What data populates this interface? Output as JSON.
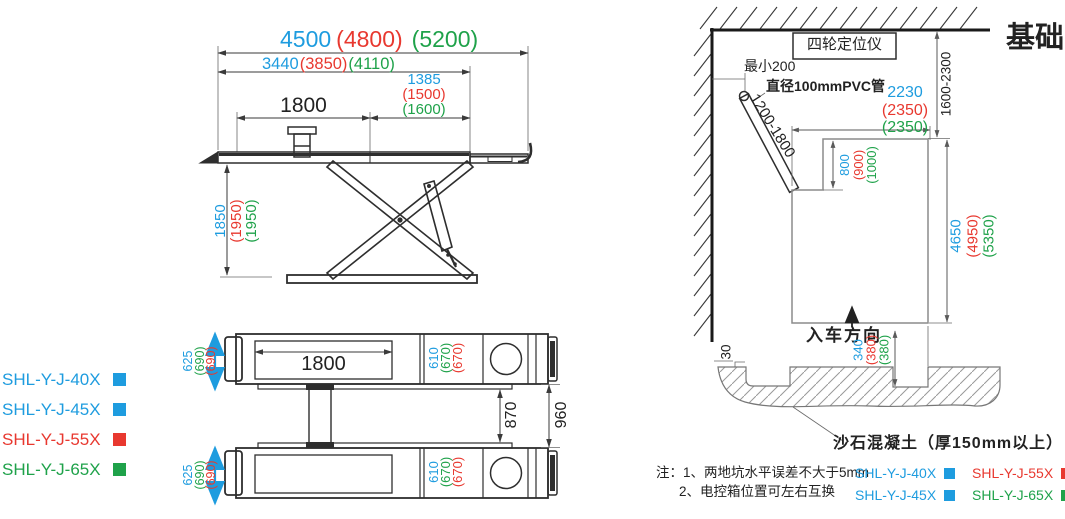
{
  "drawing": {
    "title": "基础图",
    "palette": {
      "blue": "#1E9CDF",
      "red": "#E8382F",
      "green": "#1FA24A"
    },
    "side_view": {
      "dim_total_length": {
        "v40": "4500",
        "v55": "(4800)",
        "v65": "(5200)"
      },
      "dim_inner_length": {
        "v40": "3440",
        "v55": "(3850)",
        "v65": "(4110)"
      },
      "dim_right_platform": {
        "v40": "1385",
        "v55": "(1500)",
        "v65": "(1600)"
      },
      "dim_tread_length": "1800",
      "dim_lift_height": {
        "v40": "1850",
        "v55": "(1950)",
        "v65": "(1950)"
      }
    },
    "top_view": {
      "dim_tread_length": "1800",
      "dim_platform_width": {
        "v40": "625",
        "v65": "(690)",
        "v55": "(690)"
      },
      "dim_tread_width": {
        "v40": "610",
        "v65": "(670)",
        "v55": "(670)"
      },
      "dim_inner_gap": "870",
      "dim_outer_gap": "960"
    },
    "models": [
      {
        "label": "SHL-Y-J-40X"
      },
      {
        "label": "SHL-Y-J-45X"
      },
      {
        "label": "SHL-Y-J-55X"
      },
      {
        "label": "SHL-Y-J-65X"
      }
    ],
    "foundation": {
      "aligner_label": "四轮定位仪",
      "min_clearance": "最小200",
      "pvc_label": "直径100mmPVC管",
      "pipe_length_range": "1200-1800",
      "dim_pit_width": {
        "v40": "2230",
        "v55": "(2350)",
        "v65": "(2350)"
      },
      "dim_wall_distance": "1600-2300",
      "dim_box_depth": {
        "v40": "800",
        "v55": "(900)",
        "v65": "(1000)"
      },
      "dim_pit_length": {
        "v40": "4650",
        "v55": "(4950)",
        "v65": "(5350)"
      },
      "entry_label": "入车方向",
      "dim_step_depth": {
        "v40": "340",
        "v55": "(380)",
        "v65": "(380)"
      },
      "dim_edge_step": "30",
      "concrete_label": "沙石混凝土（厚150mm以上）",
      "notes": {
        "line1": "注：1、两地坑水平误差不大于5mm",
        "line2": "2、电控箱位置可左右互换"
      },
      "legend": [
        {
          "label": "SHL-Y-J-40X"
        },
        {
          "label": "SHL-Y-J-55X"
        },
        {
          "label": "SHL-Y-J-45X"
        },
        {
          "label": "SHL-Y-J-65X"
        }
      ]
    }
  }
}
